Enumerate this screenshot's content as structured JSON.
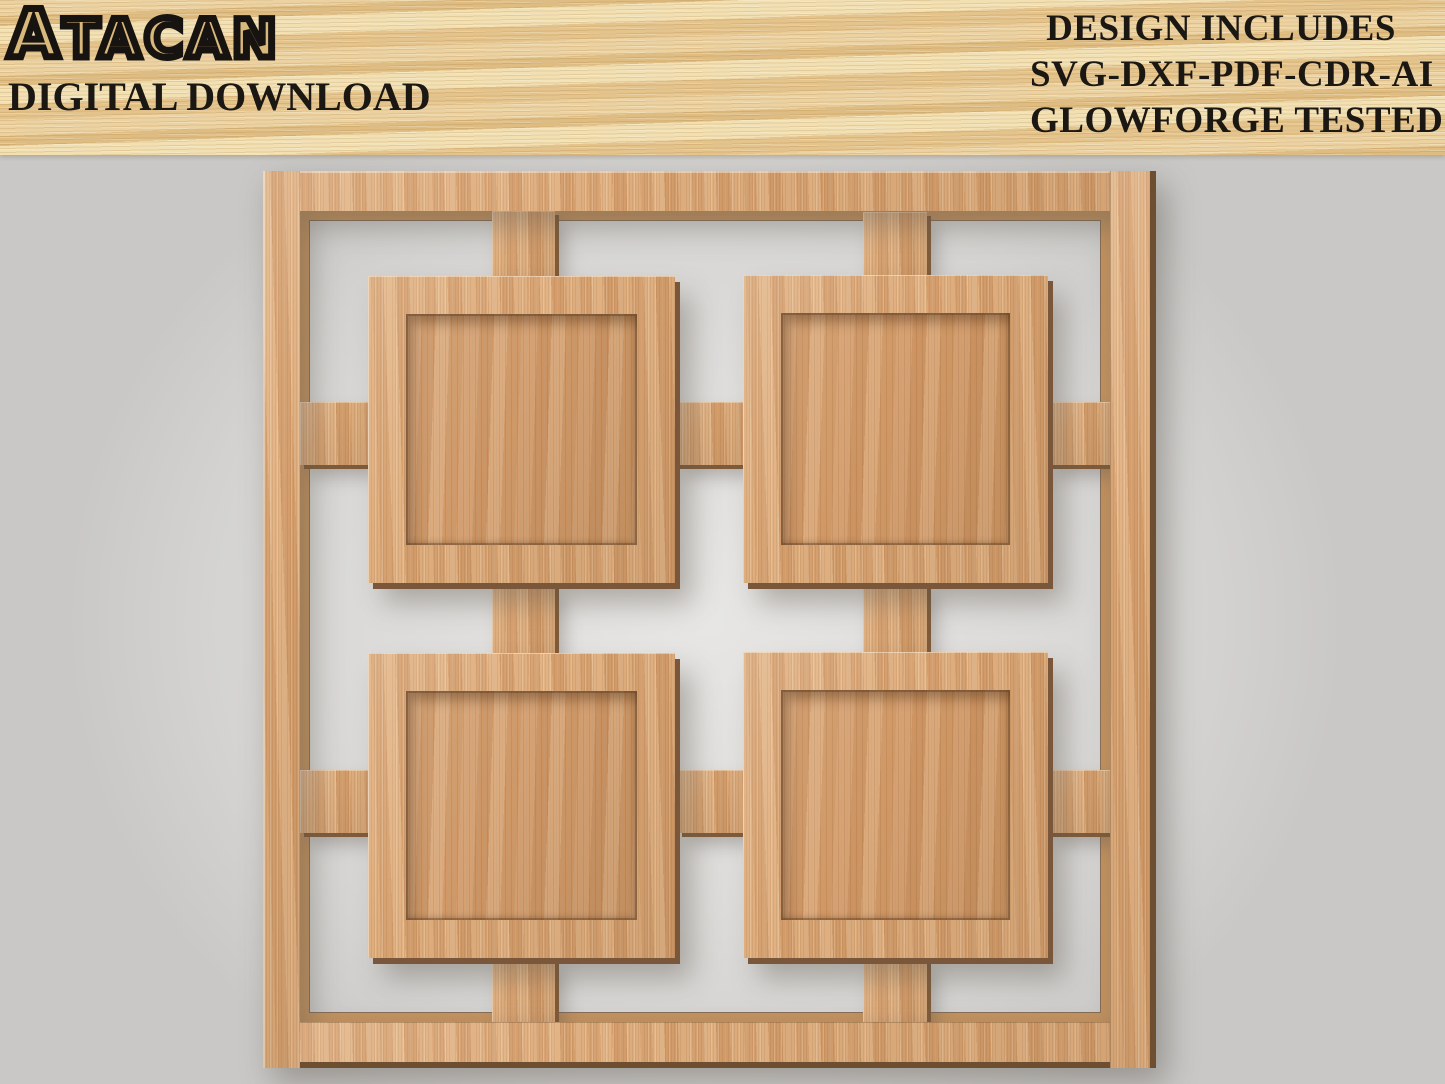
{
  "banner": {
    "logo_first": "A",
    "logo_rest": "TACAN",
    "subtitle": "DIGITAL DOWNLOAD",
    "includes_lines": [
      "DESIGN INCLUDES",
      "SVG-DXF-PDF-CDR-AI",
      "GLOWFORGE TESTED"
    ]
  },
  "artwork": {
    "description": "3D render of a square laser-cut wooden collage frame with four recessed square photo openings joined by lattice connector bars, on a light grey wall",
    "frame_openings": 4
  },
  "colors": {
    "banner_wood": "#e9cf9c",
    "text": "#1b1713",
    "frame_wood": "#dcab7c",
    "panel_wood": "#d39c6b",
    "wood_edge": "#7a573a",
    "wall": "#d8d8d6"
  }
}
